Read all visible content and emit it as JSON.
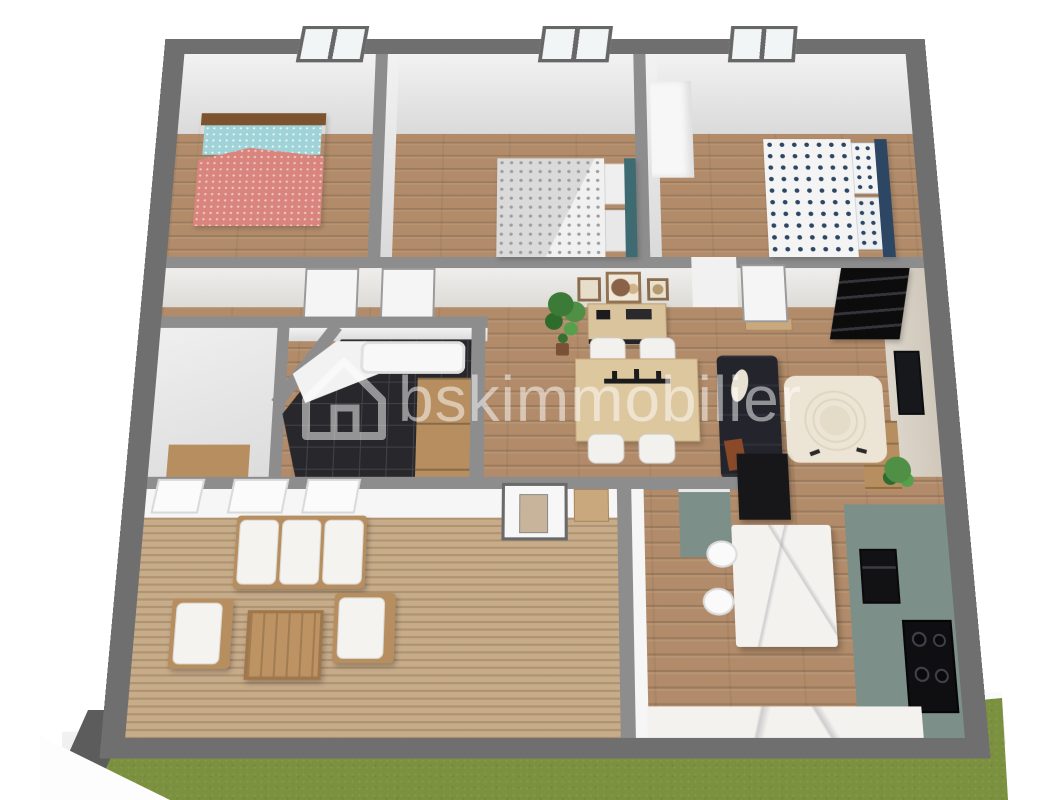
{
  "watermark": {
    "text": "bskimmobilier",
    "logo": "house-outline-icon",
    "color": "#ffffff",
    "opacity": 0.5
  },
  "palette": {
    "background": "#ffffff",
    "outer_wall": "#6f6f6f",
    "inner_wall_top": "#8d8d8d",
    "wall_face_light": "#ececec",
    "wood_floor": "#b28c6a",
    "terrace_deck": "#c7ac8a",
    "grass": "#7c9140",
    "bathroom_tile": "#28282c",
    "kitchen_cabinet_green": "#7c9089",
    "marble_white": "#f3f2ef",
    "sofa_navy": "#23242c",
    "rug_cream": "#ebe3d4",
    "dining_table_wood": "#ddc79f",
    "outdoor_furniture_wood": "#b78e5f",
    "bed1_blanket_coral": "#d9857d",
    "bed1_pillow_teal": "#9fd3d8",
    "bed1_headboard_brown": "#7d532f",
    "bed2_blanket_grey": "#dadada",
    "bed2_headboard_teal": "#3e6a72",
    "bed3_dot_navy": "#2c4663",
    "window_frame": "#676767",
    "door_sill_wood": "#c9a87e"
  },
  "scene": {
    "type": "3d-floor-plan-render",
    "view": "top-down-perspective",
    "rooms": [
      {
        "name": "bedroom-left",
        "contents": [
          "single-bed-coral",
          "window"
        ]
      },
      {
        "name": "bedroom-middle",
        "contents": [
          "double-bed-grey",
          "window"
        ]
      },
      {
        "name": "bedroom-right",
        "contents": [
          "double-bed-navy-dots",
          "wardrobe",
          "window"
        ]
      },
      {
        "name": "hallway",
        "contents": [
          "open-door-leaf",
          "open-door-leaf",
          "open-door-leaf",
          "door-sills"
        ]
      },
      {
        "name": "wc",
        "contents": [
          "cabinet"
        ]
      },
      {
        "name": "bathroom",
        "contents": [
          "black-tile-floor",
          "bathtub",
          "shower-tray",
          "cabinet"
        ]
      },
      {
        "name": "living-dining",
        "contents": [
          "plant",
          "picture-frames",
          "sideboard",
          "dining-table",
          "four-chairs",
          "sofa",
          "round-pattern-rug",
          "black-shelving-unit",
          "tv",
          "tv-stand"
        ]
      },
      {
        "name": "terrace",
        "contents": [
          "wood-deck",
          "outdoor-sofa",
          "two-armchairs",
          "coffee-table",
          "windows",
          "glazed-door"
        ]
      },
      {
        "name": "kitchen",
        "contents": [
          "marble-island",
          "two-bar-stools",
          "green-cabinet-run",
          "oven",
          "cooktop",
          "counter"
        ]
      }
    ],
    "exterior": [
      "grass-lawn",
      "white-facade",
      "two-windows",
      "walkway",
      "garden-wall-segment"
    ]
  }
}
